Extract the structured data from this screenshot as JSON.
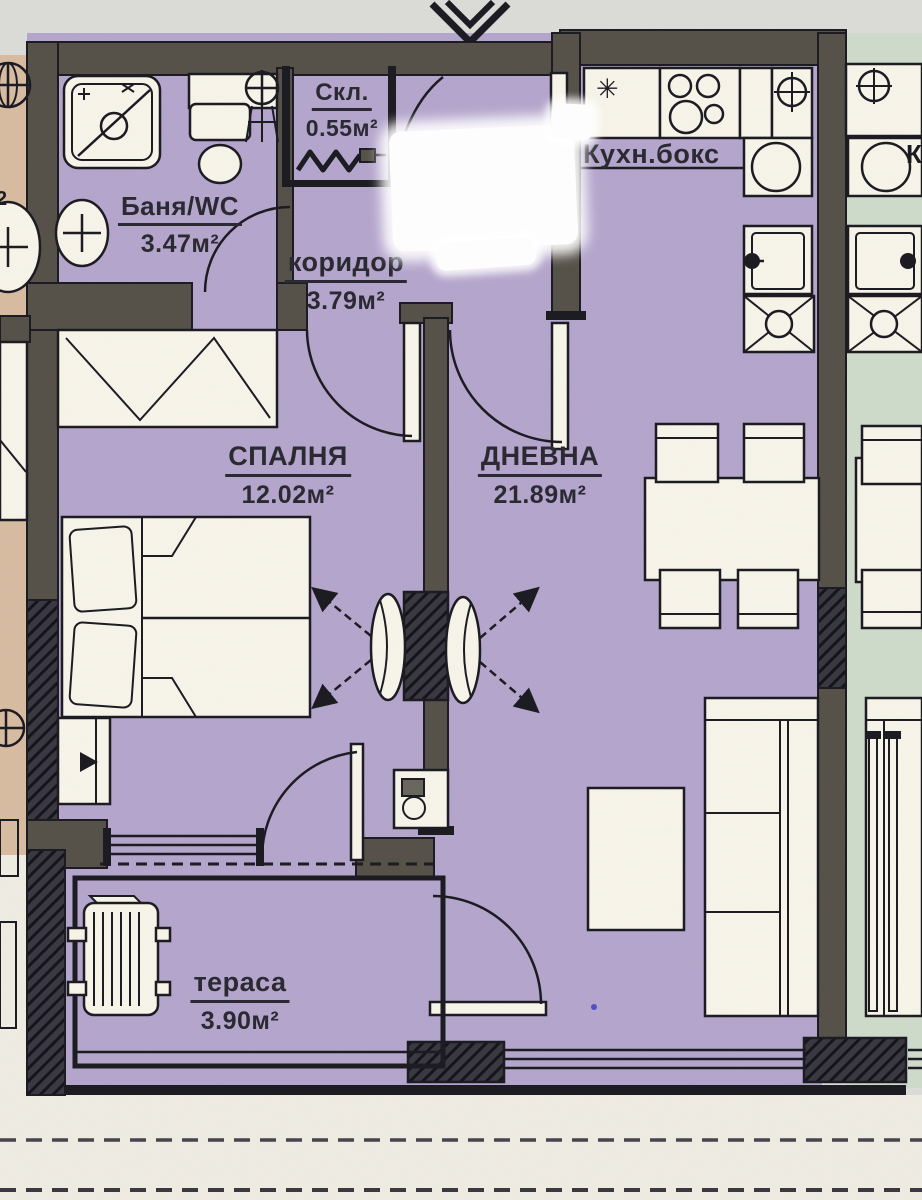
{
  "rooms": {
    "bathroom": {
      "name": "Баня/WC",
      "area": "3.47м²"
    },
    "storage": {
      "name": "Скл.",
      "area": "0.55м²"
    },
    "corridor": {
      "name": "коридор",
      "area": "3.79м²"
    },
    "kitchen": {
      "name": "Кухн.бокс"
    },
    "bedroom": {
      "name": "СПАЛНЯ",
      "area": "12.02м²"
    },
    "living_room": {
      "name": "ДНЕВНА",
      "area": "21.89м²"
    },
    "terrace": {
      "name": "тераса",
      "area": "3.90м²"
    }
  },
  "fragments": {
    "left_neighbor_area_superscript": "2",
    "right_neighbor_label_start": "К"
  },
  "icons": {
    "kitchen_star": "✳"
  },
  "colors": {
    "apartment_floor": "#b6a6cd",
    "left_neighbor_floor": "#d9bda2",
    "right_neighbor_floor": "#cfdccc",
    "wall": "#56524a",
    "linework": "#1c1b22",
    "furniture_fill": "#f8f5ea",
    "background": "#dcddd8",
    "paper": "#f0ede3",
    "ink_mark": "#4040c8"
  }
}
